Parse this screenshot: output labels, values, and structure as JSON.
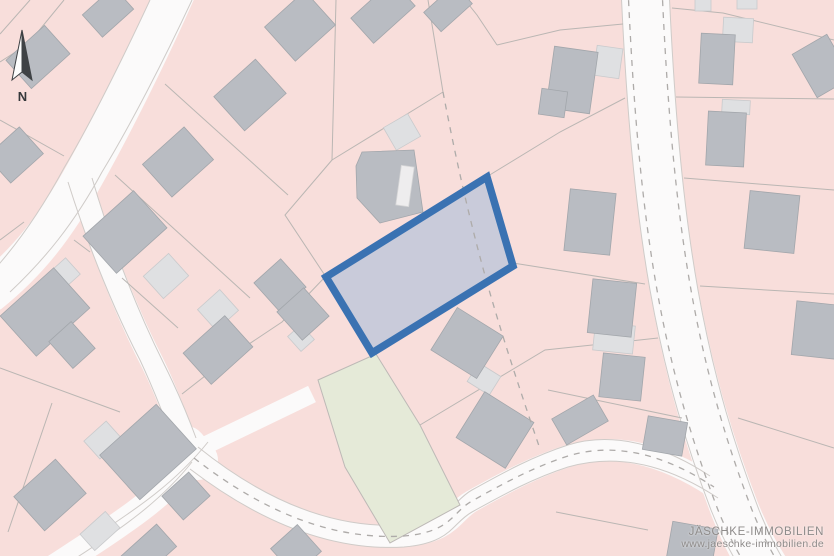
{
  "north_arrow": {
    "label": "N"
  },
  "watermark": {
    "line1": "JÄSCHKE-IMMOBILIEN",
    "line2": "www.jaeschke-immobilien.de"
  },
  "colors": {
    "parcel_pink": "#f8dedb",
    "road_white": "#fbfafa",
    "boundary_gray": "#bab6b3",
    "building_gray": "#b9bcc2",
    "structure_light_gray": "#dfe0e2",
    "green_area": "#e5ead8",
    "highlight_fill": "rgba(197,201,217,0.93)",
    "highlight_border_blue": "#3a72b2",
    "watermark_gray": "#8e8b8a"
  },
  "map": {
    "background": "#f8dedb",
    "layers": [
      {
        "name": "roads-layer",
        "item": "road",
        "style": {
          "stroke": "#fbfafa"
        },
        "items": [
          {
            "d": "M178,-14 C150,50 115,120 86,172 C55,228 28,262 -12,294",
            "style": {
              "sw": 40
            }
          },
          {
            "d": "M80,180 C102,252 128,315 152,362 C166,390 178,424 190,454",
            "style": {
              "sw": 23
            }
          },
          {
            "d": "M200,452 C168,492 130,518 84,548 C70,557 60,564 50,570",
            "style": {
              "sw": 26
            }
          },
          {
            "d": "M186,446 L198,460",
            "style": {
              "sw": 40,
              "cap": "round"
            }
          },
          {
            "d": "M200,448 L312,394",
            "style": {
              "sw": 18
            }
          },
          {
            "d": "M194,458 C268,516 338,540 404,536 C452,532 452,512 472,501 C506,482 534,467 568,456 C624,439 676,462 714,487",
            "style": {
              "sw": 22
            }
          },
          {
            "d": "M645,-12 C650,100 658,200 674,290 C690,380 712,450 735,510 C745,535 757,557 767,572",
            "style": {
              "sw": 48
            }
          }
        ]
      },
      {
        "name": "road-edges-layer",
        "item": "road-edge",
        "style": {
          "stroke": "#cfcbc8",
          "sw": 1
        },
        "items": [
          {
            "d": "M192,0 C164,60 130,126 102,172 C74,224 44,260 10,292"
          },
          {
            "d": "M150,0 C122,60 90,124 64,168 C38,216 14,248 -8,272"
          },
          {
            "d": "M68,182 C90,252 116,314 140,360 C154,390 164,416 172,438"
          },
          {
            "d": "M92,178 C114,252 140,316 164,364 C178,392 188,416 196,438"
          },
          {
            "d": "M208,442 C176,482 138,508 92,538"
          },
          {
            "d": "M192,462 C160,502 122,528 76,558"
          },
          {
            "d": "M198,447 C270,505 338,529 404,525 C452,521 452,501 472,490 C506,471 534,456 568,445 C620,429 672,451 710,476"
          },
          {
            "d": "M190,469 C266,527 338,551 404,547 C452,543 452,523 472,512 C506,493 534,478 568,467 C628,450 680,473 718,498"
          },
          {
            "d": "M621,-12 C626,100 634,200 650,290 C666,380 688,450 711,510 C721,535 733,557 743,572"
          },
          {
            "d": "M669,-12 C674,100 682,200 698,290 C714,380 736,450 759,510 C769,535 781,557 791,572"
          }
        ]
      },
      {
        "name": "green-areas-layer",
        "item": "green-area",
        "style": {
          "fill": "#e5ead8",
          "stroke": "#bdb9b6",
          "sw": 1
        },
        "items": [
          {
            "points": "318,380 376,354 420,425 460,505 390,543 345,467"
          }
        ]
      },
      {
        "name": "boundaries-layer",
        "item": "parcel-boundary",
        "style": {
          "stroke": "#bab6b3",
          "sw": 1
        },
        "items": [
          {
            "d": "M30,0 L0,34"
          },
          {
            "d": "M64,0 L28,44 L0,62"
          },
          {
            "d": "M64,156 L0,120"
          },
          {
            "d": "M24,222 L0,240"
          },
          {
            "d": "M0,368 L120,412"
          },
          {
            "d": "M52,403 L8,532"
          },
          {
            "d": "M165,84 L288,195"
          },
          {
            "d": "M115,175 L250,298"
          },
          {
            "d": "M74,240 L90,252"
          },
          {
            "d": "M122,278 L178,328"
          },
          {
            "d": "M336,0 L332,160 L285,215 L326,277"
          },
          {
            "d": "M332,160 L443,92"
          },
          {
            "d": "M428,0 L443,92"
          },
          {
            "d": "M325,277 L282,322 L228,358 L182,394"
          },
          {
            "d": "M465,0 L477,15 L497,45"
          },
          {
            "d": "M497,45 L560,30 L623,24"
          },
          {
            "d": "M672,8 L723,13 L834,40"
          },
          {
            "d": "M676,97 L834,99"
          },
          {
            "d": "M684,178 L834,190"
          },
          {
            "d": "M700,286 L834,294"
          },
          {
            "d": "M738,418 L834,448"
          },
          {
            "d": "M488,176 L560,132 L625,98"
          },
          {
            "d": "M513,263 L645,284"
          },
          {
            "d": "M420,425 L545,350 L658,338"
          },
          {
            "d": "M548,390 L682,418"
          },
          {
            "d": "M556,512 L648,530"
          }
        ]
      },
      {
        "name": "structures-layer",
        "item": "structure",
        "style": {
          "fill": "#dfe0e2",
          "stroke": "#c9cacc",
          "sw": 0.8
        },
        "items": [
          {
            "cx": 402,
            "cy": 132,
            "w": 28,
            "h": 26,
            "rot": -30
          },
          {
            "cx": 484,
            "cy": 379,
            "w": 26,
            "h": 22,
            "rot": 32
          },
          {
            "cx": 218,
            "cy": 310,
            "w": 30,
            "h": 28,
            "rot": -42
          },
          {
            "cx": 301,
            "cy": 338,
            "w": 18,
            "h": 20,
            "rot": -42
          },
          {
            "cx": 166,
            "cy": 276,
            "w": 34,
            "h": 30,
            "rot": -42
          },
          {
            "cx": 64,
            "cy": 274,
            "w": 24,
            "h": 22,
            "rot": -42
          },
          {
            "cx": 103,
            "cy": 440,
            "w": 30,
            "h": 24,
            "rot": -42
          },
          {
            "cx": 100,
            "cy": 531,
            "w": 34,
            "h": 22,
            "rot": -42
          },
          {
            "cx": 608,
            "cy": 62,
            "w": 26,
            "h": 30,
            "rot": 8
          },
          {
            "cx": 614,
            "cy": 338,
            "w": 40,
            "h": 28,
            "rot": 6
          },
          {
            "cx": 703,
            "cy": 5,
            "w": 16,
            "h": 12,
            "rot": 0
          },
          {
            "cx": 747,
            "cy": 4,
            "w": 20,
            "h": 10,
            "rot": 0
          },
          {
            "cx": 738,
            "cy": 30,
            "w": 30,
            "h": 24,
            "rot": 3
          },
          {
            "cx": 736,
            "cy": 107,
            "w": 28,
            "h": 14,
            "rot": 3
          }
        ]
      },
      {
        "name": "buildings-layer",
        "item": "building",
        "style": {
          "fill": "#b9bcc2",
          "stroke": "#a2a6ab",
          "sw": 0.8
        },
        "items": [
          {
            "cx": 38,
            "cy": 57,
            "w": 52,
            "h": 38,
            "rot": -42
          },
          {
            "cx": 108,
            "cy": 12,
            "w": 42,
            "h": 30,
            "rot": -42
          },
          {
            "cx": 15,
            "cy": 155,
            "w": 44,
            "h": 36,
            "rot": -42
          },
          {
            "cx": 250,
            "cy": 95,
            "w": 56,
            "h": 46,
            "rot": -42
          },
          {
            "cx": 178,
            "cy": 162,
            "w": 56,
            "h": 44,
            "rot": -42
          },
          {
            "cx": 125,
            "cy": 232,
            "w": 68,
            "h": 50,
            "rot": -42
          },
          {
            "cx": 45,
            "cy": 312,
            "w": 72,
            "h": 54,
            "rot": -42
          },
          {
            "cx": 72,
            "cy": 345,
            "w": 30,
            "h": 36,
            "rot": -42
          },
          {
            "cx": 300,
            "cy": 26,
            "w": 54,
            "h": 46,
            "rot": -42
          },
          {
            "cx": 383,
            "cy": 12,
            "w": 56,
            "h": 34,
            "rot": -42
          },
          {
            "cx": 448,
            "cy": 8,
            "w": 42,
            "h": 26,
            "rot": -42
          },
          {
            "cx": 572,
            "cy": 80,
            "w": 44,
            "h": 62,
            "rot": 8
          },
          {
            "cx": 553,
            "cy": 103,
            "w": 26,
            "h": 26,
            "rot": 8
          },
          {
            "points": "362,152 414,150 423,212 380,223 357,198 356,166"
          },
          {
            "cx": 405,
            "cy": 186,
            "w": 13,
            "h": 40,
            "rot": 8,
            "style": {
              "fill": "#eeedee",
              "stroke": "#d5d5d6"
            },
            "n": "building-courtyard"
          },
          {
            "cx": 717,
            "cy": 59,
            "w": 34,
            "h": 50,
            "rot": 3
          },
          {
            "cx": 726,
            "cy": 139,
            "w": 38,
            "h": 54,
            "rot": 3
          },
          {
            "cx": 822,
            "cy": 66,
            "w": 40,
            "h": 50,
            "rot": -30
          },
          {
            "cx": 590,
            "cy": 222,
            "w": 46,
            "h": 62,
            "rot": 6
          },
          {
            "cx": 612,
            "cy": 308,
            "w": 44,
            "h": 54,
            "rot": 6
          },
          {
            "cx": 622,
            "cy": 377,
            "w": 42,
            "h": 44,
            "rot": 6
          },
          {
            "cx": 580,
            "cy": 420,
            "w": 48,
            "h": 30,
            "rot": -30
          },
          {
            "cx": 772,
            "cy": 222,
            "w": 50,
            "h": 58,
            "rot": 6
          },
          {
            "cx": 816,
            "cy": 330,
            "w": 44,
            "h": 54,
            "rot": 6
          },
          {
            "cx": 665,
            "cy": 436,
            "w": 40,
            "h": 34,
            "rot": 10
          },
          {
            "cx": 692,
            "cy": 545,
            "w": 46,
            "h": 40,
            "rot": 10
          },
          {
            "cx": 467,
            "cy": 343,
            "w": 54,
            "h": 50,
            "rot": 32
          },
          {
            "cx": 495,
            "cy": 430,
            "w": 58,
            "h": 54,
            "rot": 32
          },
          {
            "cx": 148,
            "cy": 452,
            "w": 76,
            "h": 60,
            "rot": -42
          },
          {
            "cx": 186,
            "cy": 496,
            "w": 36,
            "h": 32,
            "rot": -42
          },
          {
            "cx": 50,
            "cy": 495,
            "w": 56,
            "h": 46,
            "rot": -42
          },
          {
            "cx": 148,
            "cy": 552,
            "w": 50,
            "h": 30,
            "rot": -42
          },
          {
            "cx": 296,
            "cy": 550,
            "w": 36,
            "h": 36,
            "rot": -42
          },
          {
            "cx": 218,
            "cy": 350,
            "w": 56,
            "h": 42,
            "rot": -42
          },
          {
            "cx": 280,
            "cy": 285,
            "w": 36,
            "h": 38,
            "rot": -42
          },
          {
            "cx": 303,
            "cy": 314,
            "w": 36,
            "h": 38,
            "rot": -42
          }
        ]
      },
      {
        "name": "highlight-fill-layer",
        "item": "highlighted-parcel-fill",
        "style": {
          "fill": "rgba(197,201,217,0.93)"
        },
        "items": [
          {
            "points": "487,177 513,266 372,353 326,277"
          }
        ]
      },
      {
        "name": "dashed-lines-layer",
        "item": "dashed-boundary",
        "style": {
          "stroke": "#aeaba9",
          "sw": 1.3,
          "dash": "6 6"
        },
        "items": [
          {
            "d": "M628,-12 C633,100 641,200 657,290 C673,380 695,450 718,510 C728,535 740,557 750,572",
            "n": "road-edge-dash"
          },
          {
            "d": "M662,-12 C667,100 675,200 691,290 C707,380 729,450 752,510 C762,535 774,557 784,572",
            "n": "road-edge-dash"
          },
          {
            "d": "M194,458 C268,516 338,540 404,536 C452,532 452,512 472,501 C506,482 534,467 568,456 C624,439 676,462 714,487",
            "n": "road-center-dash"
          },
          {
            "d": "M443,92 C456,160 472,232 492,300 C506,348 524,402 539,446",
            "n": "parcel-dashed-boundary"
          }
        ]
      },
      {
        "name": "highlight-border-layer",
        "item": "highlighted-parcel-border",
        "style": {
          "stroke": "#3a72b2",
          "sw": 7.5
        },
        "items": [
          {
            "points": "487,177 513,266 372,353 326,277"
          }
        ]
      }
    ]
  }
}
